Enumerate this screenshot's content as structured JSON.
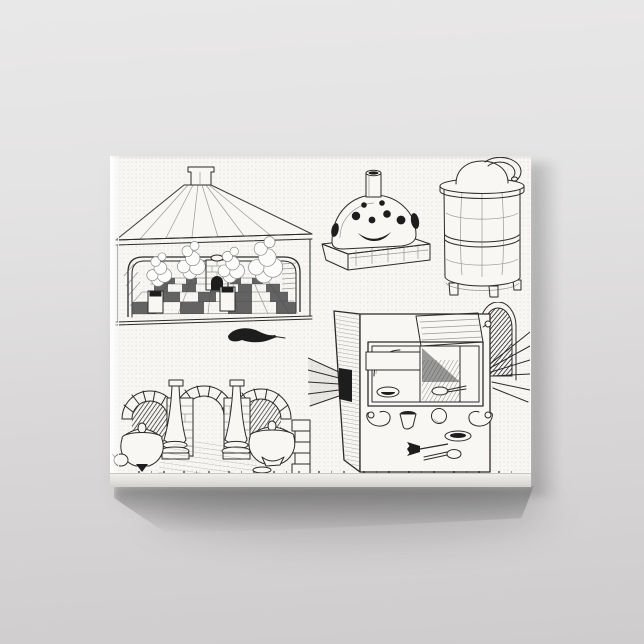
{
  "scene": {
    "type": "canvas-print-product-photo",
    "surface": "gallery-wrapped canvas hanging on a plain gray wall",
    "artwork_title": "Vintage engraving plate of early chemical furnaces and ovens"
  },
  "figures": [
    {
      "name": "distillation-house-engraving",
      "desc": "Hip-roofed pavilion with square chimney, rounded open front, checkered tile floor, four smoking box furnaces and a central brick pier"
    },
    {
      "name": "domed-furnace-engraving",
      "desc": "Mound-shaped furnace pierced with dark vent holes and crescent mouth, chimney pipe on top, set on a rectangular stone plinth"
    },
    {
      "name": "cylindrical-furnace-engraving",
      "desc": "Two-tier cylindrical furnace on small feet with collar rim, domed alembic head and curved beak spout"
    },
    {
      "name": "arched-hearths-engraving",
      "desc": "Three voussoir masonry arches with brick piers, two baluster columns, two lidded cauldrons with small jugs, dark bird-like silhouette above"
    },
    {
      "name": "cubic-furnace-engraving",
      "desc": "Cubic furnace in three-quarter view, open framed interior with raised lid and vessels, light rays from side vent and right edge, scattered implements: horns, crucible, sphere, dish, fork and spoon"
    }
  ],
  "caption": {
    "legible": false,
    "appearance": "tiny cropped letter-tops along bottom canvas fold"
  },
  "colors": {
    "wall_top": "#e9e8e8",
    "wall_bottom": "#cecccc",
    "canvas_white": "#f8f7f4",
    "canvas_edge_lit": "#ffffff",
    "canvas_wrap_bottom": "#d2d0cd",
    "ink": "#2b2b2b",
    "ink_dark_fill": "#1d1d1d",
    "shadow": "#5f5d5c"
  }
}
